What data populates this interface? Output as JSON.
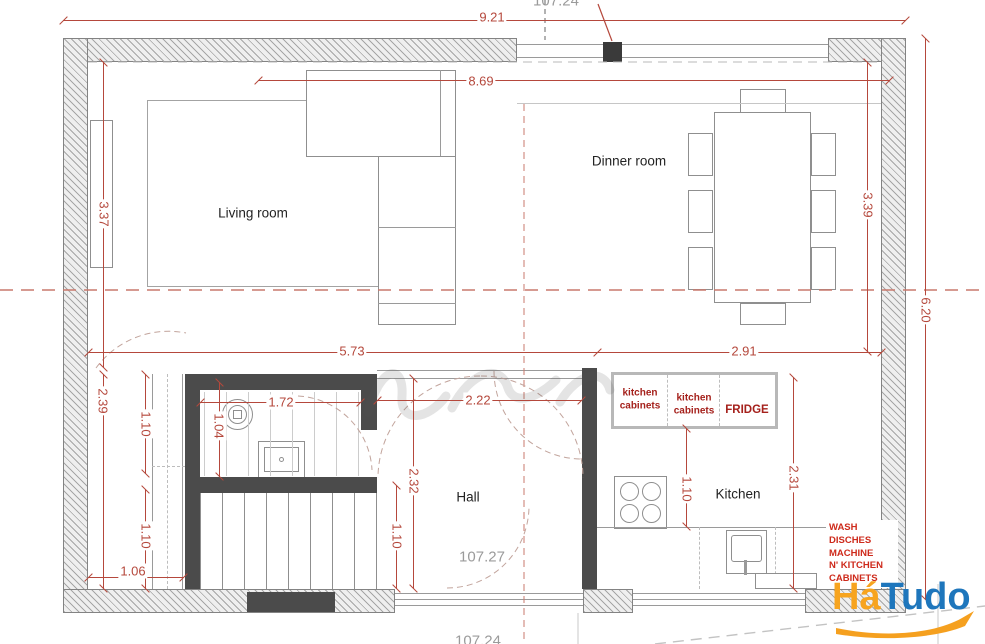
{
  "rooms": {
    "living": "Living room",
    "dinner": "Dinner room",
    "hall": "Hall",
    "kitchen": "Kitchen"
  },
  "dims": {
    "overall_width": "9.21",
    "interior_width": "8.69",
    "living_height": "3.37",
    "dinner_height": "3.39",
    "right_total_height": "6.20",
    "hall_span": "5.73",
    "kitchen_width": "2.91",
    "stairs_height": "2.39",
    "stairs_upper": "1.10",
    "stairs_lower": "1.10",
    "stairs_width": "1.06",
    "wc_width": "1.72",
    "wc_height": "1.04",
    "hall_width": "2.22",
    "hall_height": "2.32",
    "hall_lower": "1.10",
    "counter_depth": "1.10",
    "kitchen_depth": "2.31"
  },
  "levels": {
    "top": "107.24",
    "hall": "107.27",
    "bottom": "107.24"
  },
  "kitchen": {
    "cabinets1": "kitchen cabinets",
    "cabinets2": "kitchen cabinets",
    "fridge": "FRIDGE",
    "wash_lines": [
      "WASH",
      "DISCHES",
      "MACHINE",
      "N' KITCHEN",
      "CABINETS"
    ]
  },
  "logo": {
    "part1": "Há",
    "part2": "Tudo"
  },
  "colors": {
    "dimension_red": "#b5483c",
    "cabinet_red": "#a5211c",
    "wash_red": "#ce2a1b",
    "logo_orange": "#f7a41f",
    "logo_blue": "#1e76bc"
  }
}
